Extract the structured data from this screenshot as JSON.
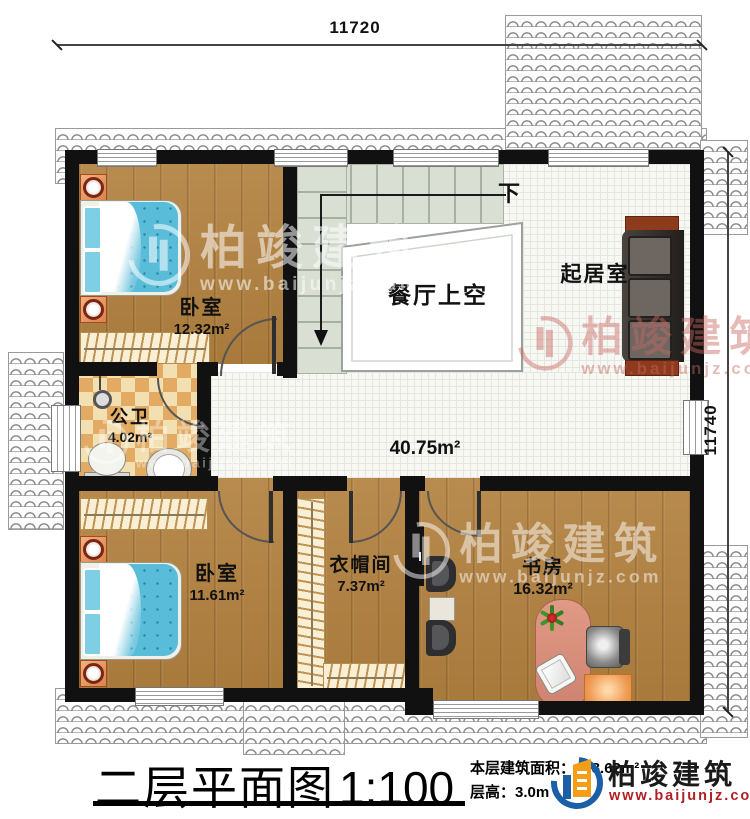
{
  "dimensions": {
    "top": "11720",
    "right": "11740"
  },
  "stairs": {
    "down": "下"
  },
  "rooms": {
    "bedroom_top": {
      "name": "卧室",
      "area": "12.32m²"
    },
    "dining_void": {
      "name": "餐厅上空"
    },
    "living_room": {
      "name": "起居室"
    },
    "bathroom": {
      "name": "公卫",
      "area": "4.02m²"
    },
    "hall": {
      "area": "40.75m²"
    },
    "bedroom_bottom": {
      "name": "卧室",
      "area": "11.61m²"
    },
    "cloakroom": {
      "name": "衣帽间",
      "area": "7.37m²"
    },
    "study": {
      "name": "书房",
      "area": "16.32m²"
    }
  },
  "watermark": {
    "name": "柏竣建筑",
    "url": "www.baijunjz.com"
  },
  "title_block": {
    "title": "二层平面图",
    "scale": "1:100",
    "area": "本层建筑面积：108.62m²",
    "floor_height": "层高：3.0m"
  },
  "brand": {
    "name": "柏竣建筑",
    "url": "www.baijunjz.com"
  },
  "colors": {
    "wall": "#111111",
    "wood_floor": "#b2813f",
    "tile_floor": "#f7f7f4",
    "stair": "#d9dfd3",
    "bed_blue": "#59bcd9",
    "checker_dark": "#e2aa62",
    "sofa": "#37322f",
    "desk_salmon": "#d88a76",
    "logo_blue": "#1b5fa7",
    "logo_orange": "#f49d16",
    "brand_red": "#b01f24"
  }
}
